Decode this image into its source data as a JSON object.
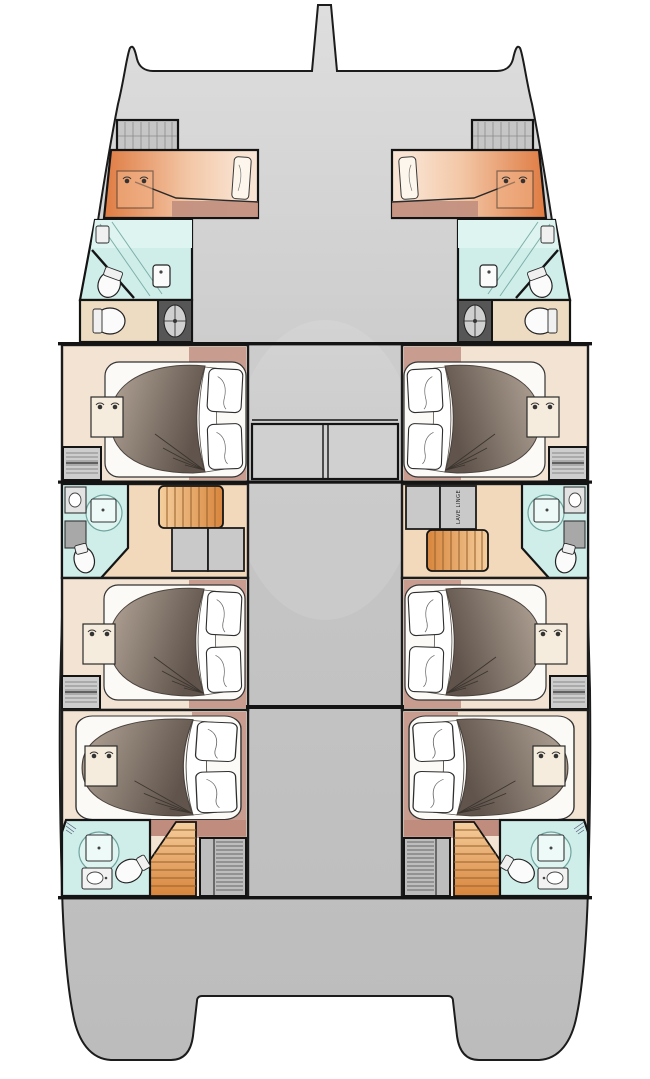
{
  "labels": {
    "washing_machine": "LAVE LINGE"
  },
  "colors": {
    "outline": "#1c1c1c",
    "hull-grey-light": "#dedede",
    "hull-grey": "#c6c6c6",
    "hull-grey-dark": "#bcbcbc",
    "deck-box-grey": "#c9c9c9",
    "cabin-floor": "#f2e3d2",
    "carpet-mauve": "#c89d90",
    "headboard-mauve": "#bf8c7d",
    "bathroom-teal": "#cfeeea",
    "bathroom-teal-light": "#ddf4f0",
    "fixture-white": "#fbfbfb",
    "corridor-sand": "#f2d9bb",
    "stairs-light": "#f5cf9e",
    "stairs-dark": "#d8853c",
    "step-line": "#96602a",
    "fwd-cabin-orange": "#df7b42",
    "fwd-cabin-mid": "#f3c7a6",
    "fwd-cabin-peach": "#f9e4d3",
    "berth-strip": "#c3907f",
    "utility-beige": "#eddcc2",
    "tech-box-dark": "#565656",
    "duvet-light": "#a89a8d",
    "duvet-dark": "#60544c"
  }
}
